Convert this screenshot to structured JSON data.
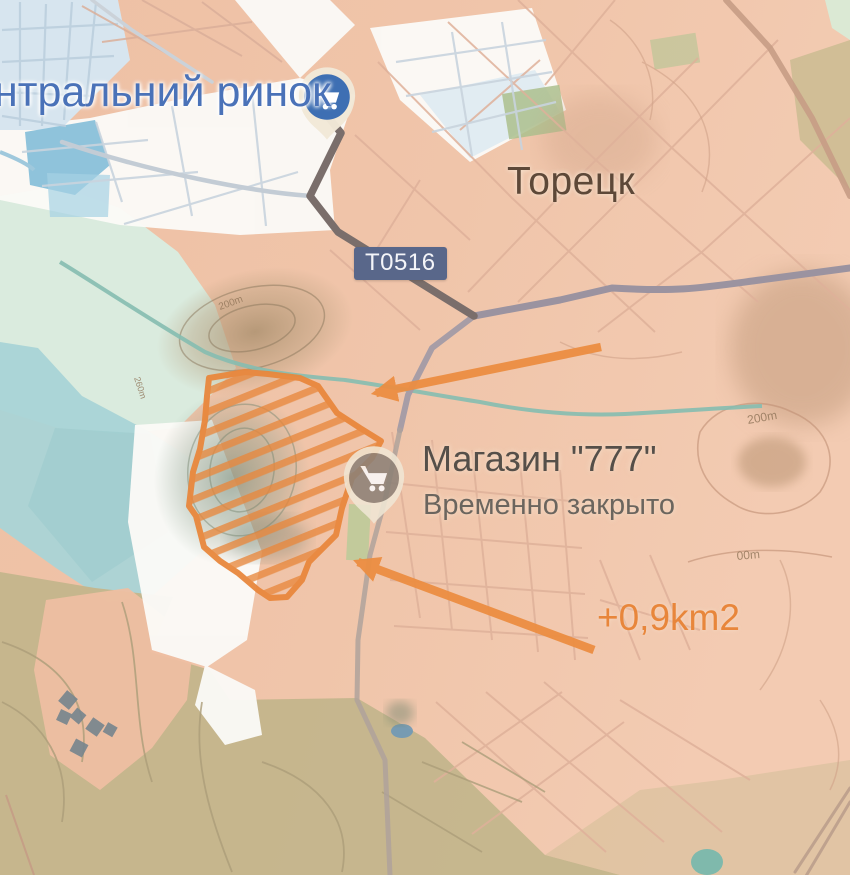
{
  "map": {
    "labels": {
      "market": "нтральний ринок",
      "city": "Торецк",
      "road_badge": "T0516",
      "poi_title": "Магазин \"777\"",
      "poi_status": "Временно закрыто",
      "area_annotation": "+0,9km2"
    },
    "contours": {
      "right_top": "200m",
      "right_bottom": "00m",
      "hill_north": "200m",
      "hill_west": "260m"
    },
    "icons": {
      "market_marker": "shopping-cart",
      "poi_marker": "shopping-cart"
    },
    "colors": {
      "annotation_orange": "#E8873D",
      "marker_blue": "#3E6FB3",
      "marker_closed_grey": "#8D8177",
      "badge_blue": "#59678A",
      "label_blue": "#4A72B8",
      "overlay_peach": "#F0C4A8",
      "zone_teal": "#A9D4D6",
      "zone_mint": "#D8EDE0",
      "zone_olive": "#C4B68C",
      "road_major": "#9B93A0",
      "road_dark": "#7A6E6B"
    }
  }
}
